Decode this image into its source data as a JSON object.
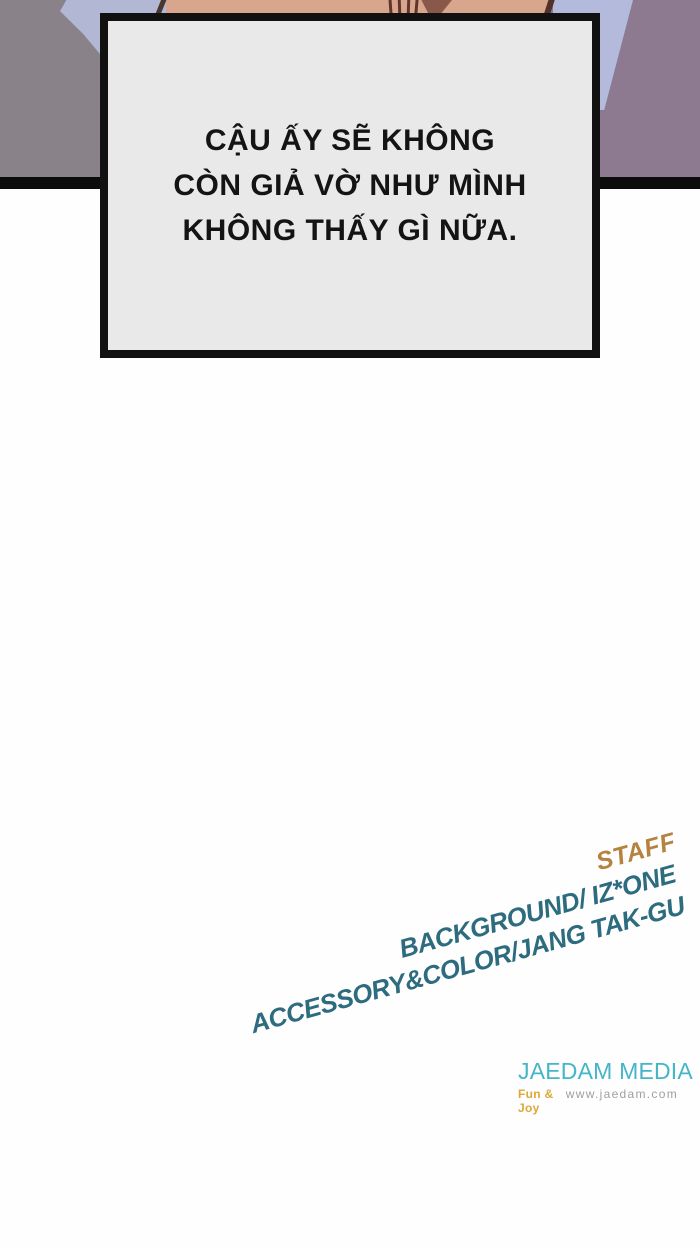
{
  "dialogue": {
    "lines": [
      "CẬU ẤY SẼ KHÔNG",
      "CÒN GIẢ VỜ NHƯ MÌNH",
      "KHÔNG THẤY GÌ NỮA."
    ]
  },
  "credits": {
    "heading": "STAFF",
    "heading_color": "#b5823f",
    "items": [
      {
        "label": "BACKGROUND/ IZ*ONE"
      },
      {
        "label": "ACCESSORY&COLOR/JANG TAK-GU"
      }
    ],
    "items_color": "#2d6b7f"
  },
  "publisher": {
    "name": "JAEDAM MEDIA",
    "name_color": "#45b5c8",
    "tagline": "Fun & Joy",
    "tagline_color": "#d9a93a",
    "website": "www.jaedam.com",
    "website_color": "#9f9f9f"
  },
  "artwork_colors": {
    "wall_left": "#8a8289",
    "wall_right": "#8e7a90",
    "skin": "#d8a68c",
    "clothing": "#b4badb",
    "panel_border": "#0c0c0c",
    "caption_fill": "#e9e9e9"
  }
}
